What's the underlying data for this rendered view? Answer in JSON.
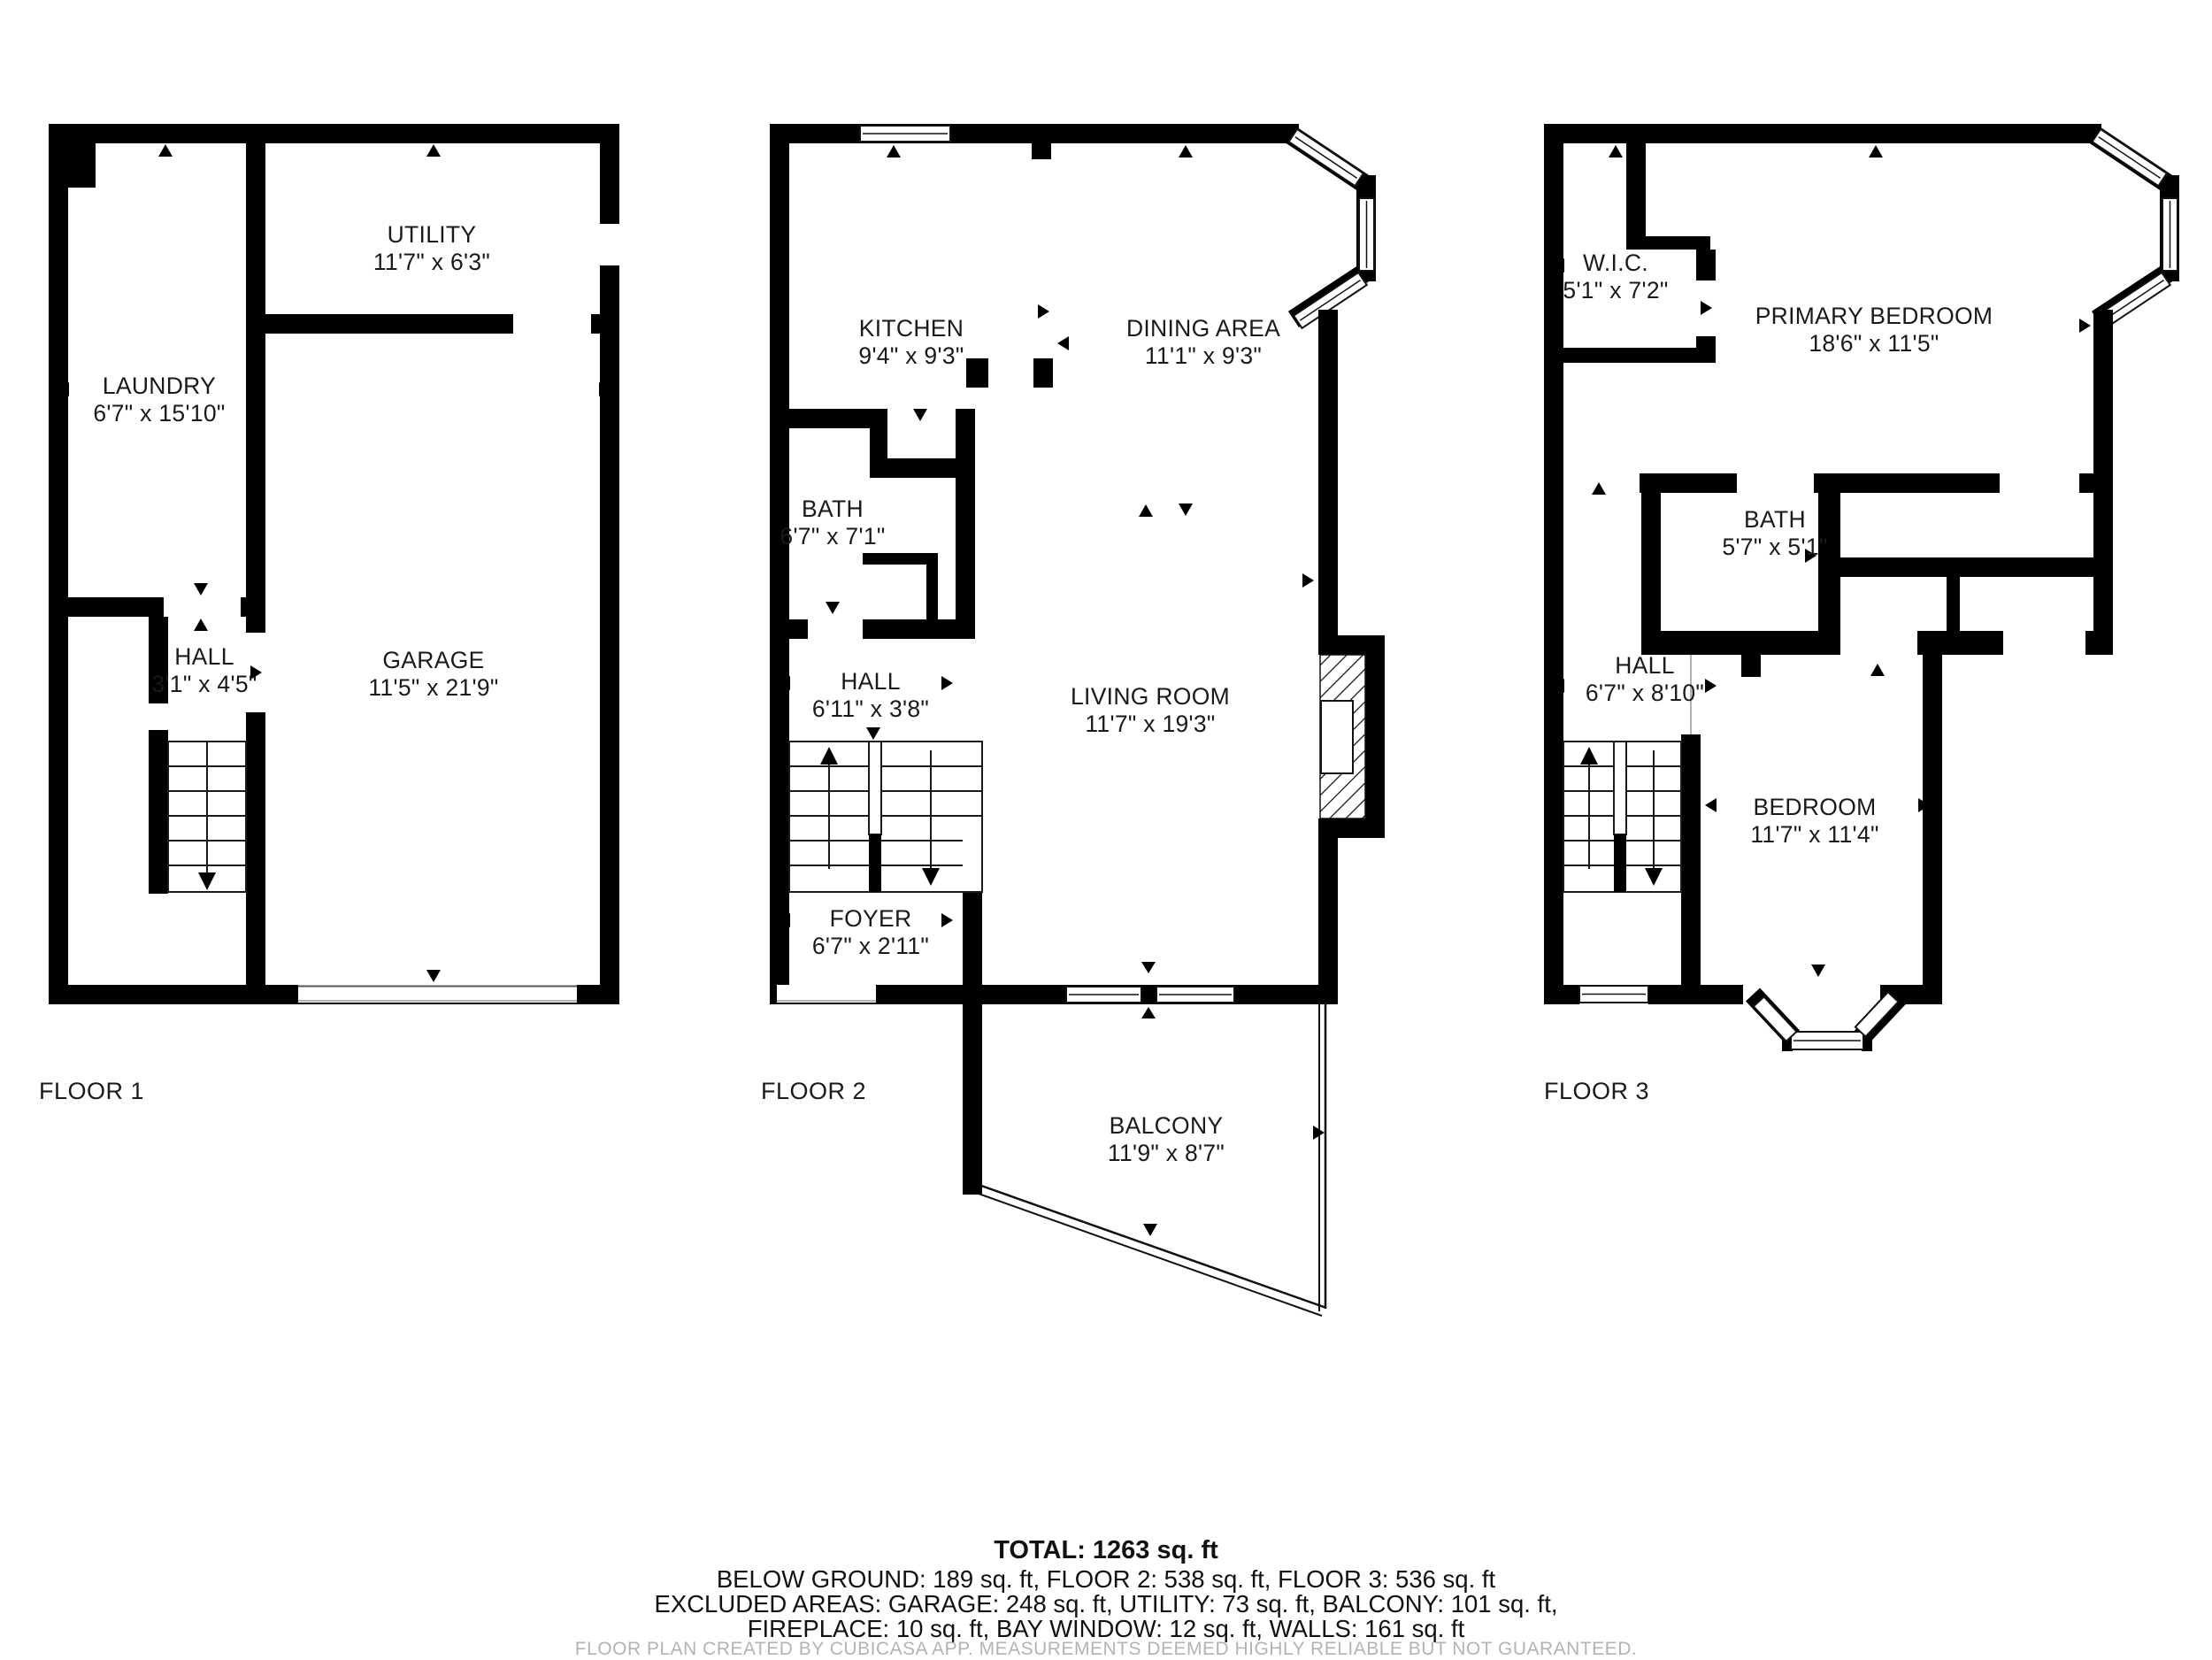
{
  "floors": [
    {
      "label": "FLOOR 1",
      "rooms": [
        {
          "name": "UTILITY",
          "dims": "11'7\" x 6'3\""
        },
        {
          "name": "LAUNDRY",
          "dims": "6'7\" x 15'10\""
        },
        {
          "name": "HALL",
          "dims": "3'1\" x 4'5\""
        },
        {
          "name": "GARAGE",
          "dims": "11'5\" x 21'9\""
        }
      ]
    },
    {
      "label": "FLOOR 2",
      "rooms": [
        {
          "name": "KITCHEN",
          "dims": "9'4\" x 9'3\""
        },
        {
          "name": "DINING AREA",
          "dims": "11'1\" x 9'3\""
        },
        {
          "name": "BATH",
          "dims": "6'7\" x 7'1\""
        },
        {
          "name": "HALL",
          "dims": "6'11\" x 3'8\""
        },
        {
          "name": "LIVING ROOM",
          "dims": "11'7\" x 19'3\""
        },
        {
          "name": "FOYER",
          "dims": "6'7\" x 2'11\""
        },
        {
          "name": "BALCONY",
          "dims": "11'9\" x 8'7\""
        }
      ]
    },
    {
      "label": "FLOOR 3",
      "rooms": [
        {
          "name": "W.I.C.",
          "dims": "5'1\" x 7'2\""
        },
        {
          "name": "PRIMARY BEDROOM",
          "dims": "18'6\" x 11'5\""
        },
        {
          "name": "BATH",
          "dims": "5'7\" x 5'1\""
        },
        {
          "name": "HALL",
          "dims": "6'7\" x 8'10\""
        },
        {
          "name": "BEDROOM",
          "dims": "11'7\" x 11'4\""
        }
      ]
    }
  ],
  "summary": {
    "total": "TOTAL: 1263 sq. ft",
    "line2": "BELOW GROUND: 189 sq. ft, FLOOR 2: 538 sq. ft, FLOOR 3: 536 sq. ft",
    "line3": "EXCLUDED AREAS: GARAGE: 248 sq. ft, UTILITY: 73 sq. ft, BALCONY: 101 sq. ft,",
    "line4": "FIREPLACE: 10 sq. ft, BAY WINDOW: 12 sq. ft, WALLS: 161 sq. ft",
    "footer": "FLOOR PLAN CREATED BY CUBICASA APP. MEASUREMENTS DEEMED HIGHLY RELIABLE BUT NOT GUARANTEED."
  }
}
